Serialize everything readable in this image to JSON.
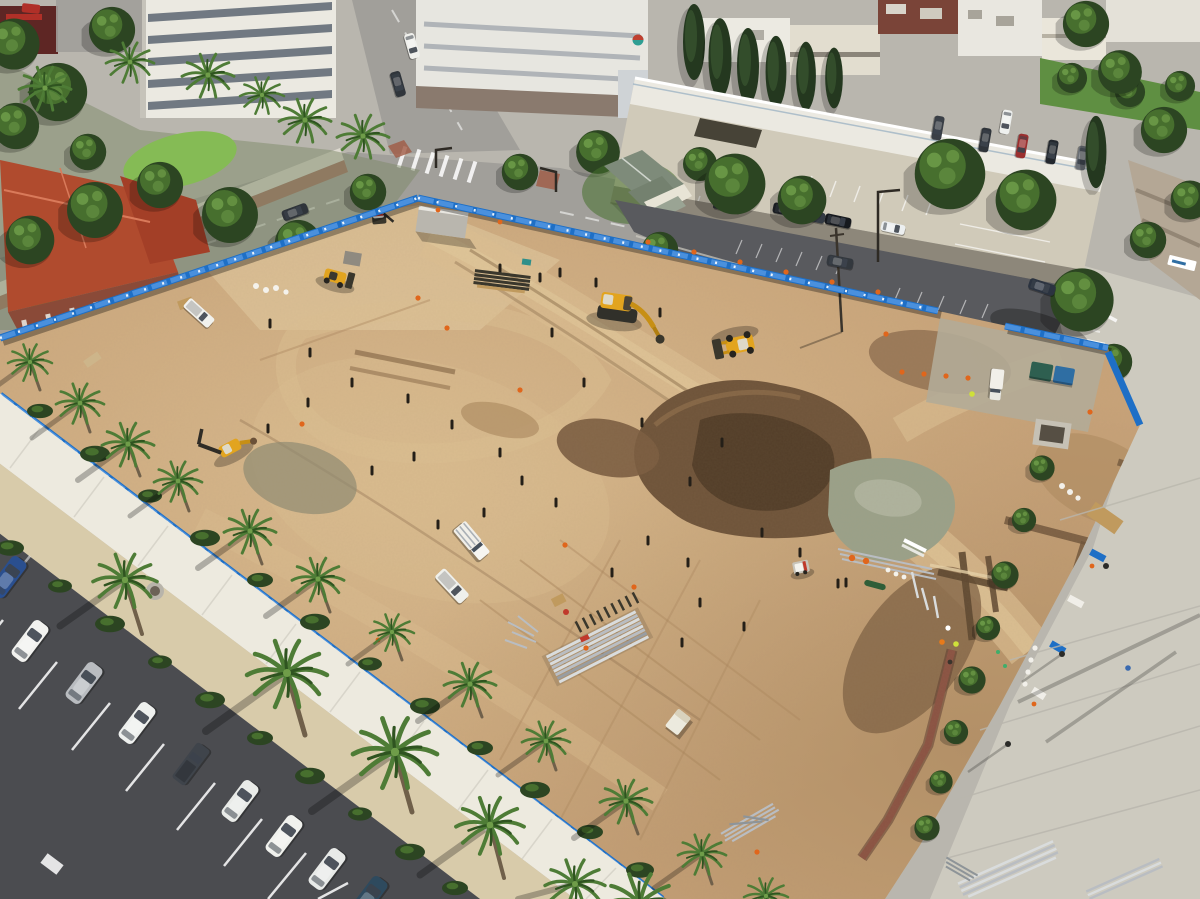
{
  "scene": {
    "title": "Aerial drone view of a downtown construction site: graded dirt lot enclosed by blue fencing, palm-lined walkways, parking lots, streets and a parking structure",
    "site": "construction-dirt-lot",
    "time_of_day": "midday",
    "vehicle_count_parked_row": 9,
    "equipment": [
      "excavator",
      "wheel-loader",
      "front-loader",
      "backhoe",
      "skid-steer",
      "mini-excavator",
      "utility-truck",
      "pickup-truck"
    ]
  },
  "palette": {
    "bg": "#b9b6ae",
    "street": "#a19f9a",
    "streetLight": "#b6b4ae",
    "sidewalk": "#ddd9cf",
    "paver": "#edeadf",
    "concrete": "#cdcabf",
    "asphalt": "#4b4c50",
    "asphaltLight": "#63646a",
    "redMedian": "#a05a44",
    "dirt": "#c8a379",
    "dirtLight": "#dcbf92",
    "dirtPale": "#e7d2a9",
    "dirtDark": "#a9855c",
    "dirtShadow": "#8a6b4a",
    "mound": "#6e5339",
    "moundDark": "#523d28",
    "gravelGreen": "#9aa189",
    "gravelGray": "#b2ab97",
    "sand": "#d8cbaa",
    "lawn": "#6aa23f",
    "lawnLight": "#85bb55",
    "treeDark": "#2c4522",
    "treeMid": "#476f2e",
    "treeLight": "#6f9d49",
    "conifer": "#24381f",
    "palmFrond": "#4e7c36",
    "palmDark": "#2f5420",
    "palmCore": "#6f9d49",
    "trunk": "#70604a",
    "fence": "#1e6fc6",
    "fenceLight": "#4a90dd",
    "fenceDark": "#14528f",
    "roofRed": "#b04b2e",
    "ridge": "#d97a5a",
    "brick": "#8a4a38",
    "white": "#f1efe9",
    "offWhite": "#dedbd2",
    "glass": "#46505c",
    "structTan": "#d0cab9",
    "structWhite": "#ebe9e1",
    "structWall": "#8d877a",
    "machineYellow": "#e2a41f",
    "machineArm": "#c78f14",
    "machineDark": "#3a372c",
    "cabLight": "#ded9c8",
    "cone": "#e0661c",
    "trench": "#8a5242",
    "trenchDark": "#5d3a30",
    "steel": "#b9bdc2",
    "steelLight": "#d9dcdd",
    "dumpGreen": "#2e5f50",
    "dumpBlue": "#2f6ea3",
    "hivisOrange": "#e87a1a",
    "hivisYellow": "#cfe03a",
    "workerBlue": "#3a6ab0",
    "redItem": "#b03028",
    "wood": "#c09a5e"
  }
}
